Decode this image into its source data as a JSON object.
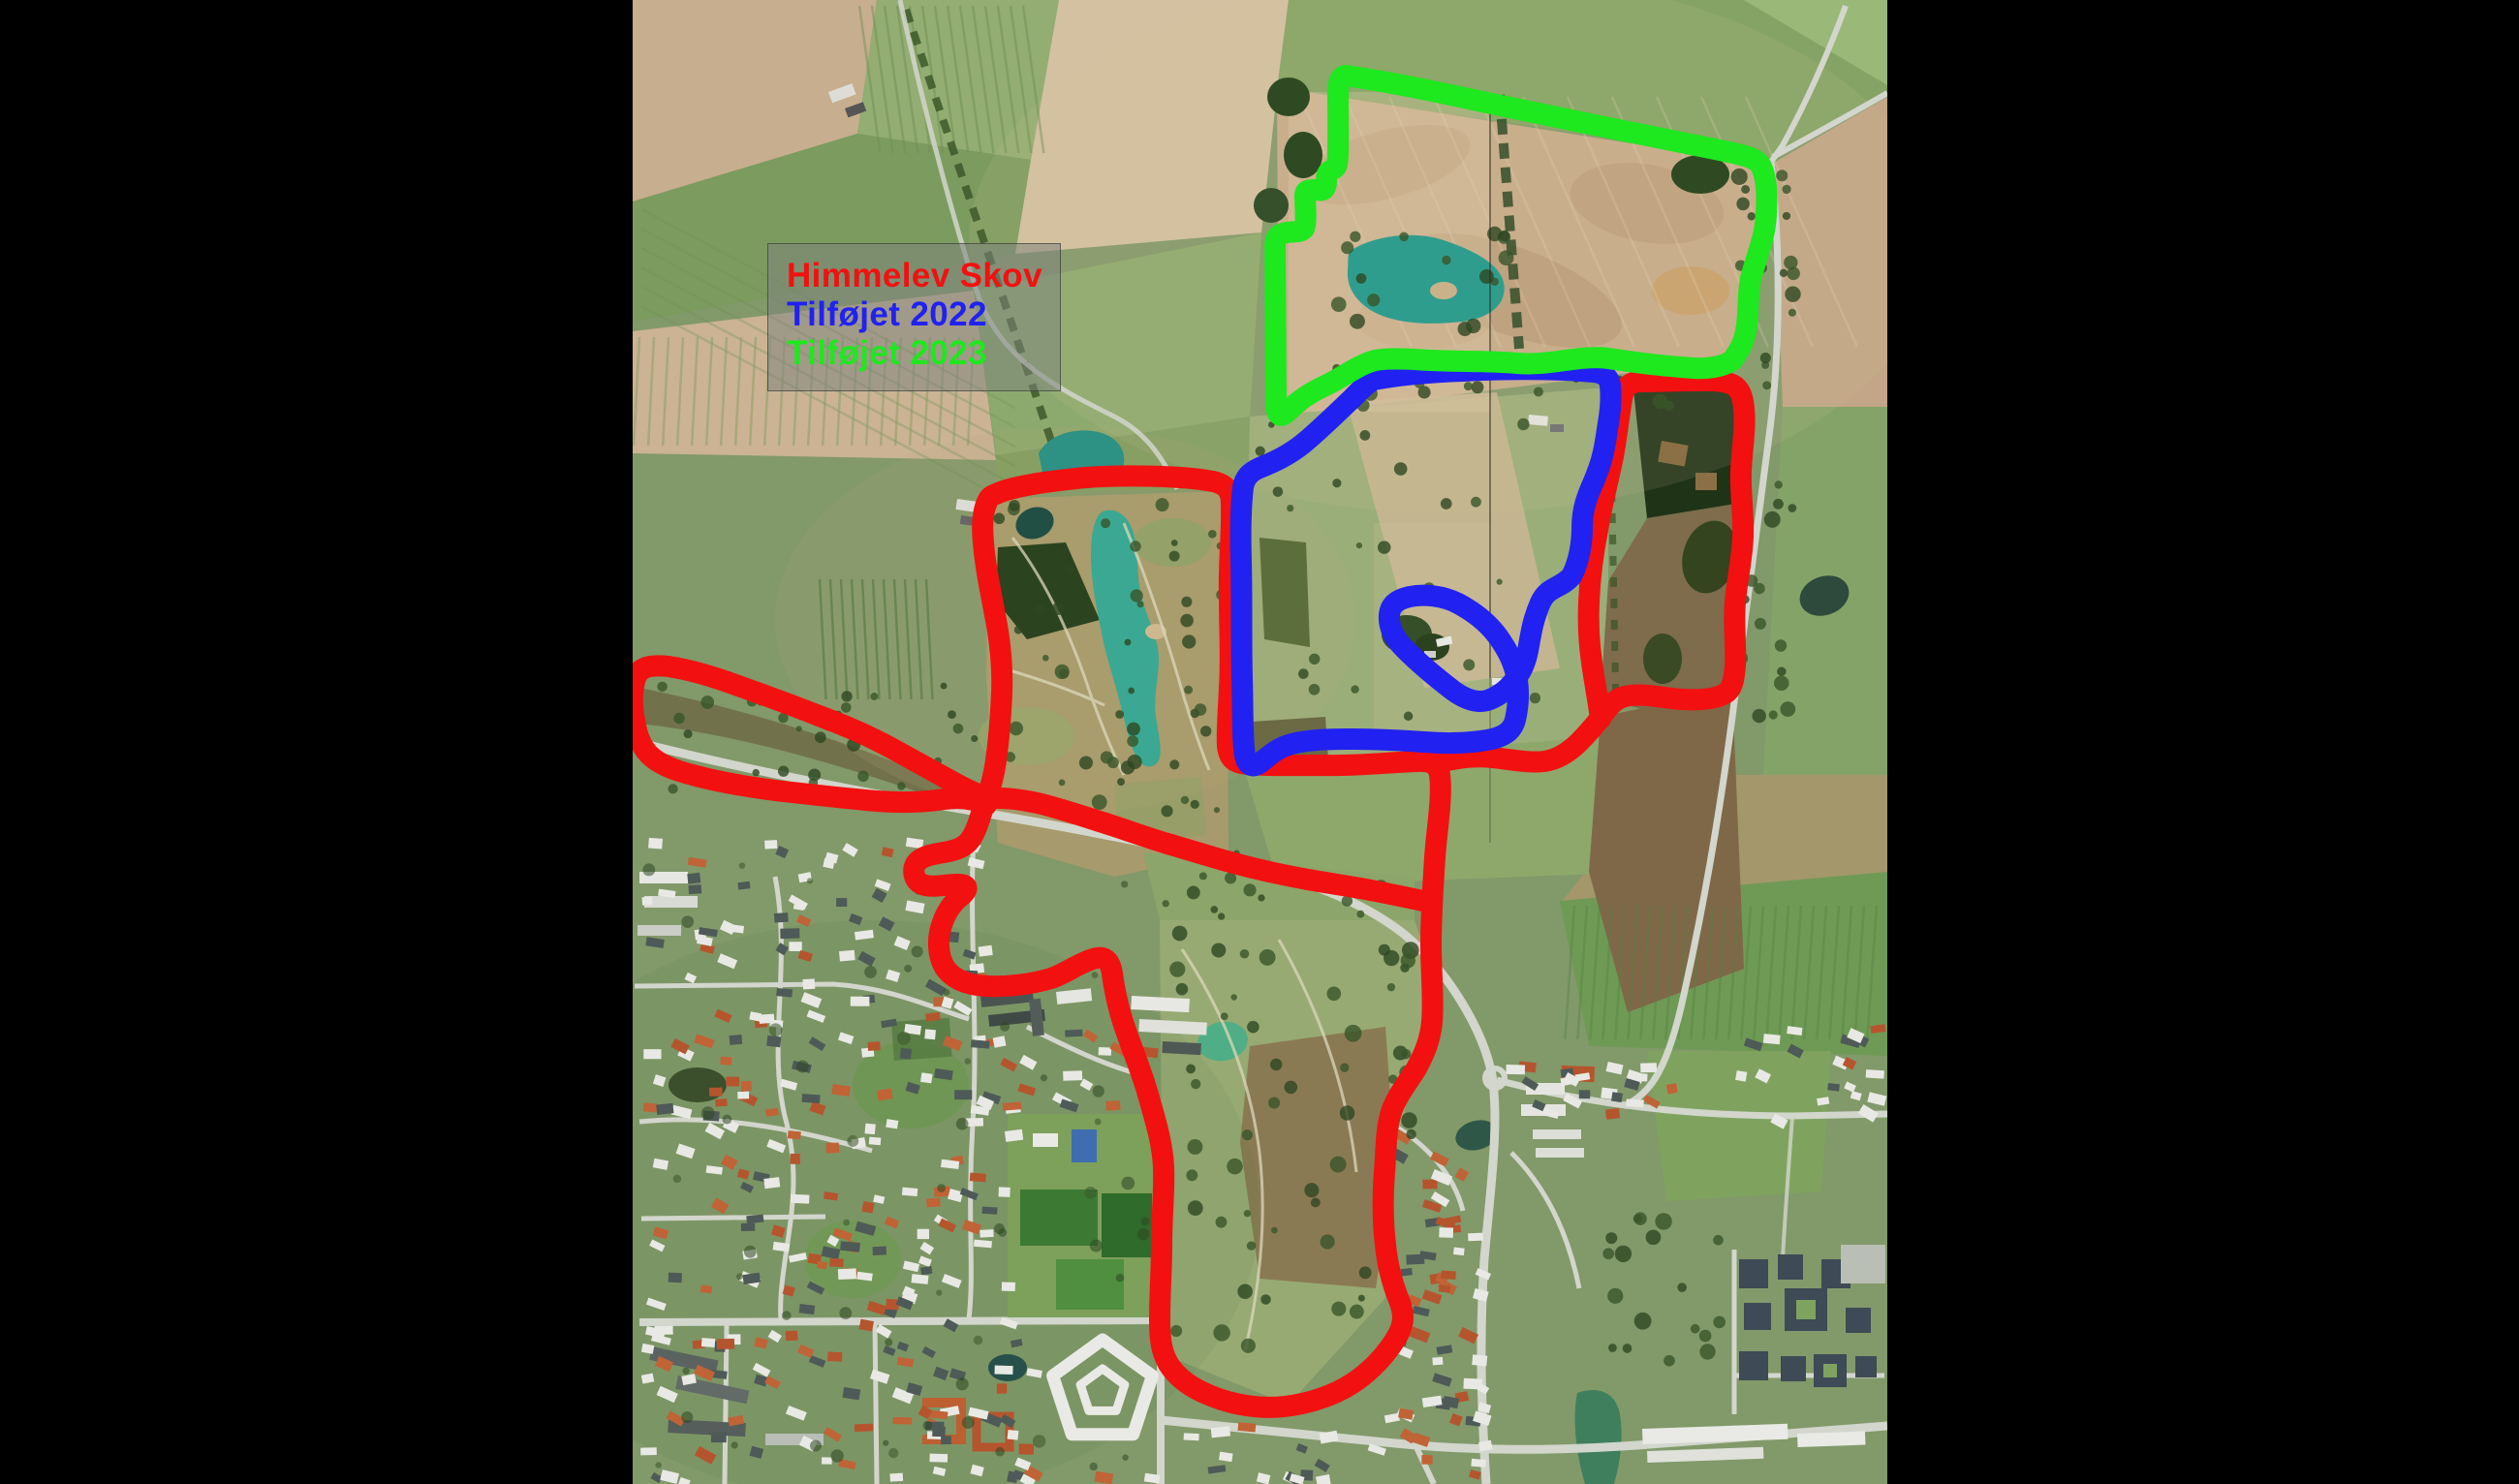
{
  "app": {
    "type": "aerial-map-annotation",
    "background_color": "#000000"
  },
  "legend": {
    "items": [
      {
        "id": "himmelev-skov",
        "label": "Himmelev Skov",
        "color": "#f31010"
      },
      {
        "id": "tilfojet-2022",
        "label": "Tilføjet 2022",
        "color": "#2121f2"
      },
      {
        "id": "tilfojet-2023",
        "label": "Tilføjet 2023",
        "color": "#1ee81e"
      }
    ]
  },
  "overlays": [
    {
      "id": "boundary-himmelev-skov",
      "label": "Himmelev Skov",
      "color": "#f31010"
    },
    {
      "id": "boundary-tilfojet-2022",
      "label": "Tilføjet 2022",
      "color": "#2121f2"
    },
    {
      "id": "boundary-tilfojet-2023",
      "label": "Tilføjet 2023",
      "color": "#1ee81e"
    }
  ]
}
